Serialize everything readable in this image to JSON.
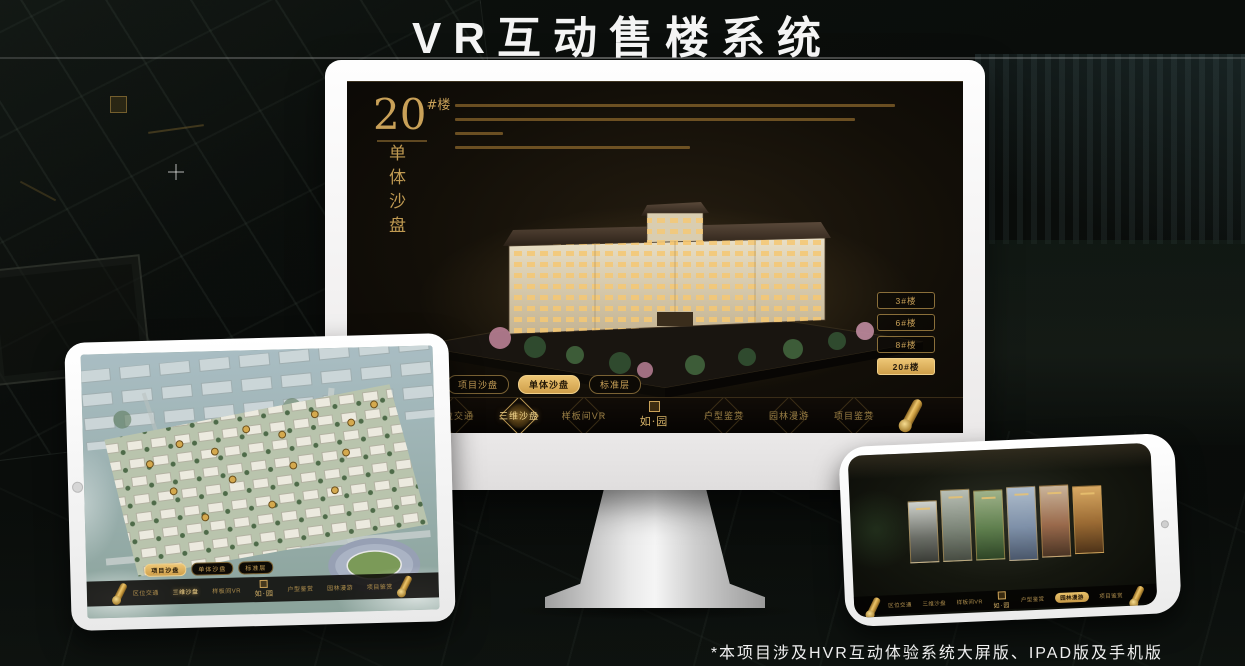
{
  "title": "VR互动售楼系统",
  "footnote": "*本项目涉及HVR互动体验系统大屏版、IPAD版及手机版",
  "brand": {
    "logo": "如·园"
  },
  "colors": {
    "gold": "#c9a158",
    "gold_bright": "#eed28a",
    "screen_brown": "#14100a",
    "device_white": "#ffffff"
  },
  "nav_items": [
    {
      "label": "区位交通"
    },
    {
      "label": "三维沙盘"
    },
    {
      "label": "样板间VR"
    },
    {
      "label": "户型鉴赏"
    },
    {
      "label": "园林漫游"
    },
    {
      "label": "项目鉴赏"
    }
  ],
  "sub_tabs": [
    {
      "label": "项目沙盘"
    },
    {
      "label": "单体沙盘"
    },
    {
      "label": "标准层"
    }
  ],
  "monitor": {
    "floor": {
      "number": "20",
      "hash": "#楼",
      "subtitle": "单体沙盘"
    },
    "buttons": [
      {
        "label": "3#楼"
      },
      {
        "label": "6#楼"
      },
      {
        "label": "8#楼"
      },
      {
        "label": "20#楼"
      }
    ]
  }
}
